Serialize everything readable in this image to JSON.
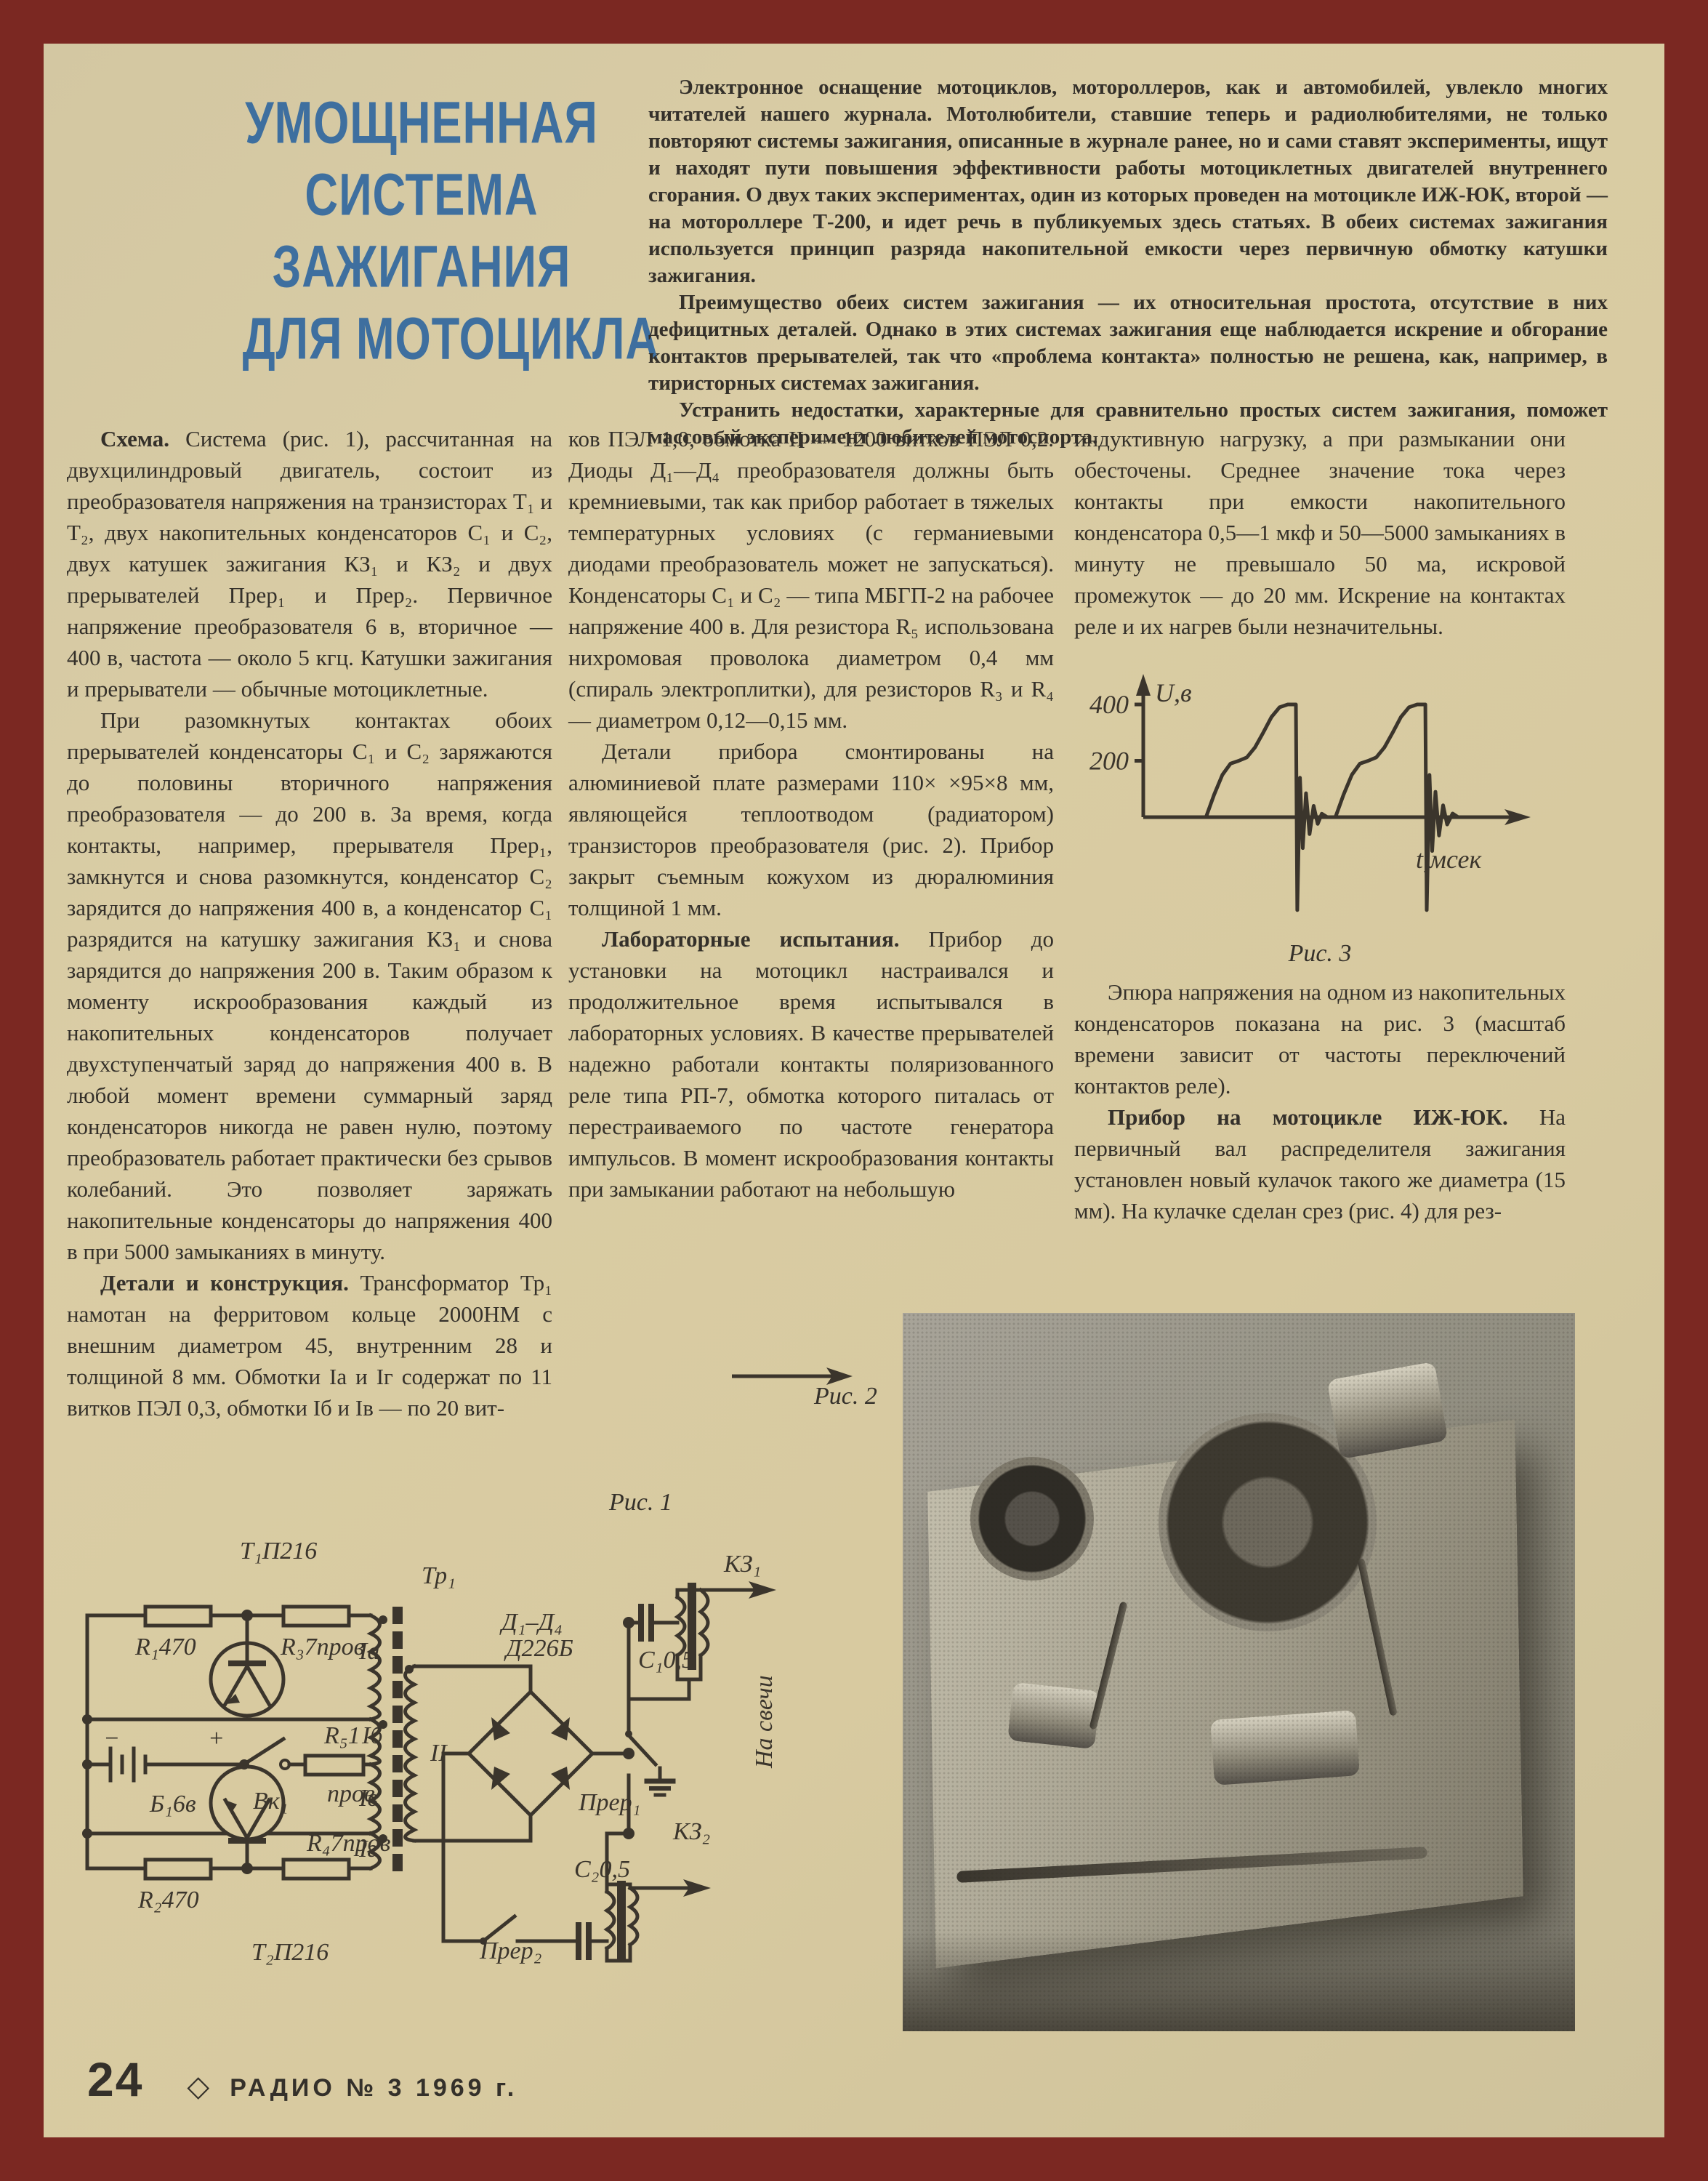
{
  "page": {
    "border_color": "#7b2822",
    "paper_color": "#d8caa0",
    "ink_color": "#3b352c",
    "accent_blue": "#3e6f9f"
  },
  "title": {
    "lines": [
      "УМОЩНЕННАЯ",
      "СИСТЕМА",
      "ЗАЖИГАНИЯ",
      "ДЛЯ  МОТОЦИКЛА"
    ]
  },
  "intro": {
    "paragraphs": [
      "Электронное оснащение мотоциклов, мотороллеров, как и автомобилей, увлекло многих читателей нашего журнала. Мотолюбители, ставшие теперь и радиолюбителями, не только повторяют системы зажигания, описанные в журнале ранее, но и сами ставят эксперименты, ищут и находят пути повышения эффективности работы мотоциклетных двигателей внутреннего сгорания. О двух таких экспериментах, один из которых проведен на мотоцикле ИЖ-ЮК, второй — на мотороллере Т-200, и идет речь в публикуемых здесь статьях. В обеих системах зажигания используется принцип разряда накопительной емкости через первичную обмотку катушки зажигания.",
      "Преимущество обеих систем зажигания — их относительная простота, отсутствие в них дефицитных деталей. Однако в этих системах зажигания еще наблюдается искрение и обгорание контактов прерывателей, так что «проблема контакта» полностью не решена, как, например, в тиристорных системах зажигания.",
      "Устранить недостатки, характерные для сравнительно простых систем зажигания, поможет массовый эксперимент любителей мотоспорта."
    ]
  },
  "columns": {
    "col1": [
      {
        "lead": "Схема.",
        "text": " Система (рис. 1), рассчитанная на двухцилиндровый двигатель, состоит из преобразователя напряжения на транзисторах Т₁ и Т₂, двух накопительных конденсаторов С₁ и С₂, двух катушек зажигания КЗ₁ и КЗ₂ и двух прерывателей Прер₁ и Прер₂. Первичное напряжение преобразователя 6 в, вторичное — 400 в, частота — около 5 кгц. Катушки зажигания и прерыватели — обычные мотоциклетные."
      },
      {
        "lead": "",
        "text": "При разомкнутых контактах обоих прерывателей конденсаторы С₁ и С₂ заряжаются до половины вторичного напряжения преобразователя — до 200 в. За время, когда контакты, например, прерывателя Прер₁, замкнутся и снова разомкнутся, конденсатор С₂ зарядится до напряжения 400 в, а конденсатор С₁ разрядится на катушку зажигания КЗ₁ и снова зарядится до напряжения 200 в. Таким образом к моменту искрообразования каждый из накопительных конденсаторов получает двухступенчатый заряд до напряжения 400 в. В любой момент времени суммарный заряд конденсаторов никогда не равен нулю, поэтому преобразователь работает практически без срывов колебаний. Это позволяет заряжать накопительные конденсаторы до напряжения 400 в при 5000 замыканиях в минуту."
      },
      {
        "lead": "Детали и конструкция.",
        "text": " Трансформатор Тр₁ намотан на ферритовом кольце 2000НМ с внешним диаметром 45, внутренним 28 и толщиной 8 мм. Обмотки Iа и Iг содержат по 11 витков ПЭЛ 0,3, обмотки Iб и Iв — по 20 вит-"
      }
    ],
    "col2": [
      {
        "lead": "",
        "text": "ков ПЭЛ 1,0, обмотка II — 1200 витков ПЭЛ 0,2. Диоды Д₁—Д₄ преобразователя должны быть кремниевыми, так как прибор работает в тяжелых температурных условиях (с германиевыми диодами преобразователь может не запускаться). Конденсаторы С₁ и С₂ — типа МБГП-2 на рабочее напряжение 400 в. Для резистора R₅ использована нихромовая проволока диаметром 0,4 мм (спираль электроплитки), для резисторов R₃ и R₄ — диаметром 0,12—0,15 мм."
      },
      {
        "lead": "",
        "text": "Детали прибора смонтированы на алюминиевой плате размерами 110× ×95×8 мм, являющейся теплоотводом (радиатором) транзисторов преобразователя (рис. 2). Прибор закрыт съемным кожухом из дюралюминия толщиной 1 мм."
      },
      {
        "lead": "Лабораторные испытания.",
        "text": " Прибор до установки на мотоцикл настраивался и продолжительное время испытывался в лабораторных условиях. В качестве прерывателей надежно работали контакты поляризованного реле типа РП-7, обмотка которого питалась от перестраиваемого по частоте генератора импульсов. В момент искрообразования контакты при замыкании работают на небольшую"
      }
    ],
    "col3": [
      {
        "lead": "",
        "text": "индуктивную нагрузку, а при размыкании они обесточены. Среднее значение тока через контакты при емкости накопительного конденсатора 0,5—1 мкф и 50—5000 замыканиях в минуту не превышало 50 ма, искровой промежуток — до 20 мм. Искрение на контактах реле и их нагрев были незначительны."
      },
      {
        "lead": "",
        "text": "Эпюра напряжения на одном из накопительных конденсаторов показана на рис. 3 (масштаб времени зависит от частоты переключений контактов реле)."
      },
      {
        "lead": "Прибор на мотоцикле ИЖ-ЮК.",
        "text": " На первичный вал распределителя зажигания установлен новый кулачок такого же диаметра (15 мм). На кулачке сделан срез (рис. 4) для рез-"
      }
    ]
  },
  "figures": {
    "fig1_caption": "Рис. 1",
    "fig2_caption": "Рис. 2",
    "fig3_caption": "Рис. 3"
  },
  "chart_data": {
    "type": "line",
    "title": "Рис. 3",
    "xlabel": "t,мсек",
    "ylabel": "U,в",
    "yticks": [
      200,
      400
    ],
    "xlim": [
      0,
      14
    ],
    "ylim": [
      -360,
      450
    ],
    "grid": false,
    "legend": "none",
    "description": "Эпюра напряжения на накопительном конденсаторе: двухступенчатый заряд до 400 в, затем разряд с затухающими колебаниями",
    "series": [
      {
        "name": "U на накопительном конденсаторе",
        "points": [
          [
            0,
            0
          ],
          [
            2.3,
            0
          ],
          [
            2.6,
            80
          ],
          [
            2.9,
            150
          ],
          [
            3.2,
            190
          ],
          [
            3.5,
            200
          ],
          [
            3.8,
            212
          ],
          [
            4.1,
            248
          ],
          [
            4.4,
            300
          ],
          [
            4.7,
            355
          ],
          [
            5.0,
            390
          ],
          [
            5.3,
            400
          ],
          [
            5.6,
            400
          ],
          [
            5.65,
            -330
          ],
          [
            5.75,
            140
          ],
          [
            5.85,
            -110
          ],
          [
            5.97,
            85
          ],
          [
            6.1,
            -60
          ],
          [
            6.25,
            40
          ],
          [
            6.4,
            -24
          ],
          [
            6.55,
            12
          ],
          [
            6.75,
            0
          ],
          [
            7.05,
            0
          ],
          [
            7.35,
            80
          ],
          [
            7.65,
            150
          ],
          [
            7.95,
            190
          ],
          [
            8.25,
            200
          ],
          [
            8.55,
            212
          ],
          [
            8.85,
            248
          ],
          [
            9.15,
            300
          ],
          [
            9.45,
            355
          ],
          [
            9.75,
            390
          ],
          [
            10.05,
            400
          ],
          [
            10.35,
            400
          ],
          [
            10.4,
            -330
          ],
          [
            10.5,
            150
          ],
          [
            10.6,
            -120
          ],
          [
            10.72,
            90
          ],
          [
            10.85,
            -65
          ],
          [
            11.0,
            42
          ],
          [
            11.15,
            -26
          ],
          [
            11.35,
            13
          ],
          [
            11.55,
            0
          ],
          [
            12.2,
            0
          ]
        ]
      }
    ]
  },
  "schematic": {
    "labels": [
      {
        "t": "Т₁П216",
        "x": 240,
        "y": 62
      },
      {
        "t": "R₁470",
        "x": 96,
        "y": 194
      },
      {
        "t": "R₃7пров",
        "x": 296,
        "y": 194
      },
      {
        "t": "Тр₁",
        "x": 490,
        "y": 96
      },
      {
        "t": "Д₁–Д₄",
        "x": 600,
        "y": 160
      },
      {
        "t": "Д226Б",
        "x": 606,
        "y": 196
      },
      {
        "t": "Iа",
        "x": 404,
        "y": 200
      },
      {
        "t": "Iб",
        "x": 408,
        "y": 316
      },
      {
        "t": "R₅1",
        "x": 356,
        "y": 316
      },
      {
        "t": "пров",
        "x": 360,
        "y": 396
      },
      {
        "t": "Вк₁",
        "x": 258,
        "y": 406
      },
      {
        "t": "Б₁6в",
        "x": 116,
        "y": 410
      },
      {
        "t": "−",
        "x": 52,
        "y": 320
      },
      {
        "t": "+",
        "x": 196,
        "y": 320
      },
      {
        "t": "Iв",
        "x": 404,
        "y": 402
      },
      {
        "t": "Iг",
        "x": 404,
        "y": 472
      },
      {
        "t": "II",
        "x": 502,
        "y": 340
      },
      {
        "t": "C₁0,5",
        "x": 788,
        "y": 212
      },
      {
        "t": "КЗ₁",
        "x": 906,
        "y": 80
      },
      {
        "t": "Прер₁",
        "x": 706,
        "y": 408
      },
      {
        "t": "КЗ₂",
        "x": 836,
        "y": 448
      },
      {
        "t": "C₂0,5",
        "x": 700,
        "y": 500
      },
      {
        "t": "Прер₂",
        "x": 570,
        "y": 612
      },
      {
        "t": "R₂470",
        "x": 100,
        "y": 542
      },
      {
        "t": "R₄7пров",
        "x": 332,
        "y": 464
      },
      {
        "t": "Т₂П216",
        "x": 256,
        "y": 614
      },
      {
        "t": "На свечи",
        "x": 972,
        "y": 350,
        "r": -90
      }
    ]
  },
  "footer": {
    "page_number": "24",
    "diamond": "◇",
    "journal": "РАДИО № 3 1969 г."
  }
}
